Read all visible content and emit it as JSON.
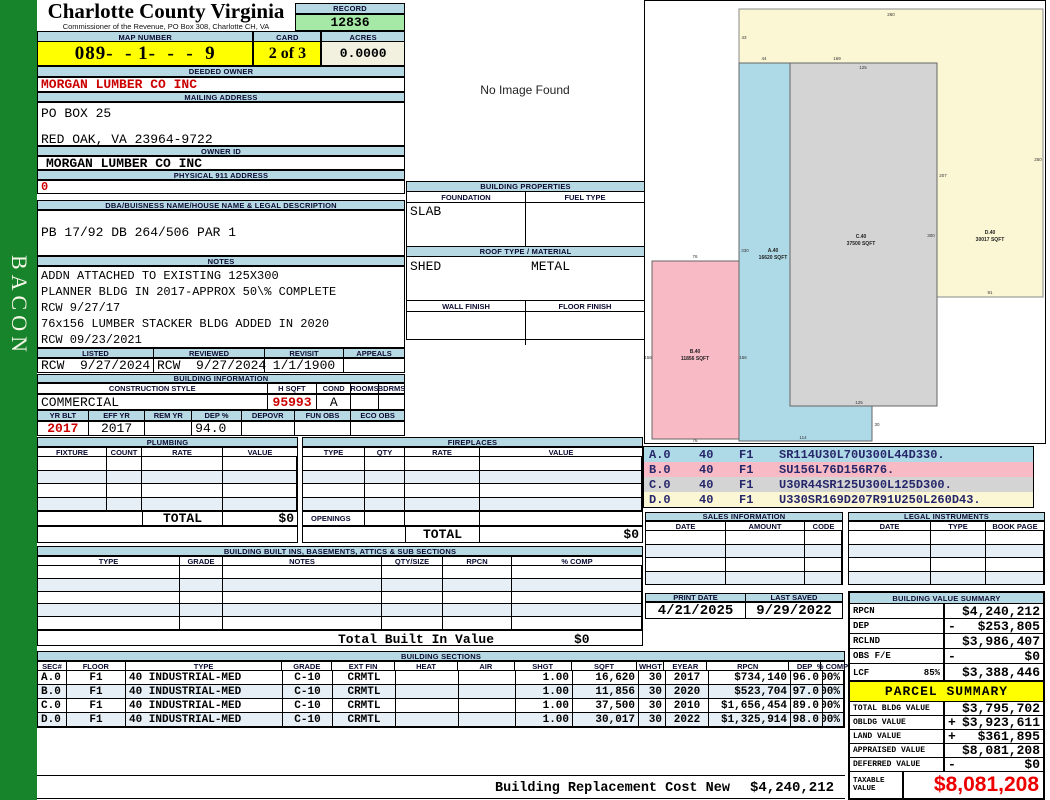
{
  "colors": {
    "sidebar_green": "#17842c",
    "header_bar_blue": "#b7d9e3",
    "highlight_yellow": "#ffff00",
    "record_green": "#a6e8a6",
    "acres_cream": "#f2f1e0",
    "alt_row_blue": "#e6eff5",
    "red_text": "#cc0000",
    "taxable_red": "#ee0000",
    "stripe_navy": "#26266a",
    "sketch_cream": "#fbf7d4",
    "sketch_blue": "#aedae7",
    "sketch_gray": "#d4d4d4",
    "sketch_pink": "#f8bac4"
  },
  "sidebar": {
    "vertical_label": "BACON"
  },
  "header": {
    "county_title": "Charlotte County Virginia",
    "county_subtitle": "Commissioner of the Revenue, PO Box 308, Charlotte CH, VA",
    "record_label": "RECORD",
    "record_number": "12836",
    "map_number_label": "MAP NUMBER",
    "map_number": "089-  - 1-  -  -  9",
    "card_label": "CARD",
    "card": "2 of 3",
    "acres_label": "ACRES",
    "acres": "0.0000"
  },
  "owner": {
    "deeded_owner_label": "DEEDED OWNER",
    "deeded_owner": "MORGAN LUMBER CO INC",
    "mailing_address_label": "MAILING ADDRESS",
    "mailing_address_line1": "PO BOX 25",
    "mailing_address_line2": "RED OAK, VA 23964-9722",
    "owner_id_label": "OWNER ID",
    "owner_id": "MORGAN LUMBER CO INC",
    "physical_911_label": "PHYSICAL 911 ADDRESS",
    "physical_911": "0",
    "legal_label": "DBA/BUISNESS NAME/HOUSE NAME & LEGAL DESCRIPTION",
    "legal_description": "PB 17/92 DB 264/506 PAR 1",
    "notes_label": "NOTES",
    "notes": [
      "ADDN ATTACHED TO EXISTING 125X300",
      "PLANNER BLDG IN 2017-APPROX 50\\% COMPLETE",
      "RCW 9/27/17",
      "76x156 LUMBER STACKER BLDG ADDED IN 2020",
      "RCW 09/23/2021"
    ]
  },
  "visits": {
    "listed_label": "LISTED",
    "listed": "RCW  9/27/2024",
    "reviewed_label": "REVIEWED",
    "reviewed": "RCW  9/27/2024",
    "revisit_label": "REVISIT",
    "revisit": "1/1/1900",
    "appeals_label": "APPEALS",
    "appeals": ""
  },
  "building_info": {
    "section_label": "BUILDING INFORMATION",
    "construction_style_label": "CONSTRUCTION STYLE",
    "construction_style": "COMMERCIAL",
    "hsqft_label": "H SQFT",
    "hsqft": "95993",
    "cond_label": "COND",
    "cond": "A",
    "rooms_label": "ROOMS",
    "rooms": "",
    "bdrms_label": "BDRMS",
    "bdrms": "",
    "yr_blt_label": "YR BLT",
    "yr_blt": "2017",
    "eff_yr_label": "EFF YR",
    "eff_yr": "2017",
    "rem_yr_label": "REM YR",
    "rem_yr": "",
    "dep_pct_label": "DEP %",
    "dep_pct": "94.0",
    "depovr_label": "DEPOVR",
    "depovr": "",
    "fun_obs_label": "FUN OBS",
    "fun_obs": "",
    "eco_obs_label": "ECO OBS",
    "eco_obs": ""
  },
  "photo": {
    "placeholder": "No Image Found"
  },
  "building_properties": {
    "section_label": "BUILDING PROPERTIES",
    "foundation_label": "FOUNDATION",
    "foundation": "SLAB",
    "fuel_type_label": "FUEL TYPE",
    "fuel_type": "",
    "roof_label": "ROOF TYPE / MATERIAL",
    "roof_type": "SHED",
    "roof_material": "METAL",
    "wall_finish_label": "WALL FINISH",
    "wall_finish": "",
    "floor_finish_label": "FLOOR FINISH",
    "floor_finish": ""
  },
  "plumbing": {
    "section_label": "PLUMBING",
    "headers": [
      "FIXTURE",
      "COUNT",
      "RATE",
      "VALUE"
    ],
    "rows": [
      [
        "",
        "",
        "",
        ""
      ],
      [
        "",
        "",
        "",
        ""
      ],
      [
        "",
        "",
        "",
        ""
      ],
      [
        "",
        "",
        "",
        ""
      ]
    ],
    "total_label": "TOTAL",
    "total": "$0"
  },
  "fireplaces": {
    "section_label": "FIREPLACES",
    "headers": [
      "TYPE",
      "QTY",
      "RATE",
      "VALUE"
    ],
    "rows": [
      [
        "",
        "",
        "",
        ""
      ],
      [
        "",
        "",
        "",
        ""
      ],
      [
        "",
        "",
        "",
        ""
      ],
      [
        "",
        "",
        "",
        ""
      ]
    ],
    "openings_label": "OPENINGS",
    "total_label": "TOTAL",
    "total": "$0"
  },
  "built_ins": {
    "section_label": "BUILDING BUILT INS, BASEMENTS, ATTICS & SUB SECTIONS",
    "headers": [
      "TYPE",
      "GRADE",
      "NOTES",
      "QTY/SIZE",
      "RPCN",
      "% COMP"
    ],
    "rows": [
      [
        "",
        "",
        "",
        "",
        "",
        ""
      ],
      [
        "",
        "",
        "",
        "",
        "",
        ""
      ],
      [
        "",
        "",
        "",
        "",
        "",
        ""
      ],
      [
        "",
        "",
        "",
        "",
        "",
        ""
      ],
      [
        "",
        "",
        "",
        "",
        "",
        ""
      ]
    ],
    "total_label": "Total Built In Value",
    "total": "$0"
  },
  "building_sections": {
    "section_label": "BUILDING SECTIONS",
    "headers": [
      "SEC#",
      "FLOOR",
      "TYPE",
      "GRADE",
      "EXT FIN",
      "HEAT",
      "AIR",
      "SHGT",
      "SQFT",
      "WHGT",
      "EYEAR",
      "RPCN",
      "DEP",
      "% COMP"
    ],
    "rows": [
      [
        "A.0",
        "F1",
        "40 INDUSTRIAL-MED",
        "C-10",
        "CRMTL",
        "",
        "",
        "1.00",
        "16,620",
        "30",
        "2017",
        "$734,140",
        "96.0",
        "100%"
      ],
      [
        "B.0",
        "F1",
        "40 INDUSTRIAL-MED",
        "C-10",
        "CRMTL",
        "",
        "",
        "1.00",
        "11,856",
        "30",
        "2020",
        "$523,704",
        "97.0",
        "100%"
      ],
      [
        "C.0",
        "F1",
        "40 INDUSTRIAL-MED",
        "C-10",
        "CRMTL",
        "",
        "",
        "1.00",
        "37,500",
        "30",
        "2010",
        "$1,656,454",
        "89.0",
        "100%"
      ],
      [
        "D.0",
        "F1",
        "40 INDUSTRIAL-MED",
        "C-10",
        "CRMTL",
        "",
        "",
        "1.00",
        "30,017",
        "30",
        "2022",
        "$1,325,914",
        "98.0",
        "100%"
      ]
    ],
    "replacement_label": "Building Replacement Cost New",
    "replacement_value": "$4,240,212"
  },
  "sketch": {
    "vectors": [
      {
        "sec": "A.0",
        "code": "40",
        "floor": "F1",
        "vector": "SR114U30L70U300L44D330."
      },
      {
        "sec": "B.0",
        "code": "40",
        "floor": "F1",
        "vector": "SU156L76D156R76."
      },
      {
        "sec": "C.0",
        "code": "40",
        "floor": "F1",
        "vector": "U30R44SR125U300L125D300."
      },
      {
        "sec": "D.0",
        "code": "40",
        "floor": "F1",
        "vector": "U330SR169D207R91U250L260D43."
      }
    ],
    "areas": [
      {
        "id": "A",
        "label": "A.40",
        "sqft": "16620 SQFT"
      },
      {
        "id": "B",
        "label": "B.40",
        "sqft": "11856 SQFT"
      },
      {
        "id": "C",
        "label": "C.40",
        "sqft": "37500 SQFT"
      },
      {
        "id": "D",
        "label": "D.40",
        "sqft": "30017 SQFT"
      }
    ],
    "dims": [
      "260",
      "43",
      "250",
      "169",
      "207",
      "91",
      "125",
      "300",
      "125",
      "44",
      "330",
      "114",
      "30",
      "76",
      "156",
      "156",
      "76"
    ]
  },
  "sales": {
    "section_label": "SALES INFORMATION",
    "headers": [
      "DATE",
      "AMOUNT",
      "CODE"
    ],
    "rows": [
      [
        "",
        "",
        ""
      ],
      [
        "",
        "",
        ""
      ],
      [
        "",
        "",
        ""
      ],
      [
        "",
        "",
        ""
      ]
    ]
  },
  "legal_instruments": {
    "section_label": "LEGAL INSTRUMENTS",
    "headers": [
      "DATE",
      "TYPE",
      "BOOK PAGE"
    ],
    "rows": [
      [
        "",
        "",
        ""
      ],
      [
        "",
        "",
        ""
      ],
      [
        "",
        "",
        ""
      ],
      [
        "",
        "",
        ""
      ]
    ]
  },
  "dates": {
    "print_date_label": "PRINT DATE",
    "print_date": "4/21/2025",
    "last_saved_label": "LAST SAVED",
    "last_saved": "9/29/2022"
  },
  "building_value_summary": {
    "section_label": "BUILDING VALUE SUMMARY",
    "rows": [
      {
        "label": "RPCN",
        "pct": "",
        "op": "",
        "value": "$4,240,212"
      },
      {
        "label": "DEP",
        "pct": "",
        "op": "-",
        "value": "$253,805"
      },
      {
        "label": "RCLND",
        "pct": "",
        "op": "",
        "value": "$3,986,407"
      },
      {
        "label": "OBS F/E",
        "pct": "",
        "op": "-",
        "value": "$0"
      },
      {
        "label": "LCF",
        "pct": "85%",
        "op": "",
        "value": "$3,388,446"
      }
    ]
  },
  "parcel_summary": {
    "section_label": "PARCEL SUMMARY",
    "rows": [
      {
        "label": "TOTAL BLDG VALUE",
        "op": "",
        "value": "$3,795,702"
      },
      {
        "label": "OBLDG VALUE",
        "op": "+",
        "value": "$3,923,611"
      },
      {
        "label": "LAND VALUE",
        "op": "+",
        "value": "$361,895"
      },
      {
        "label": "APPRAISED VALUE",
        "op": "",
        "value": "$8,081,208"
      },
      {
        "label": "DEFERRED VALUE",
        "op": "-",
        "value": "$0"
      }
    ],
    "taxable_label": "TAXABLE\nVALUE",
    "taxable_value": "$8,081,208"
  }
}
